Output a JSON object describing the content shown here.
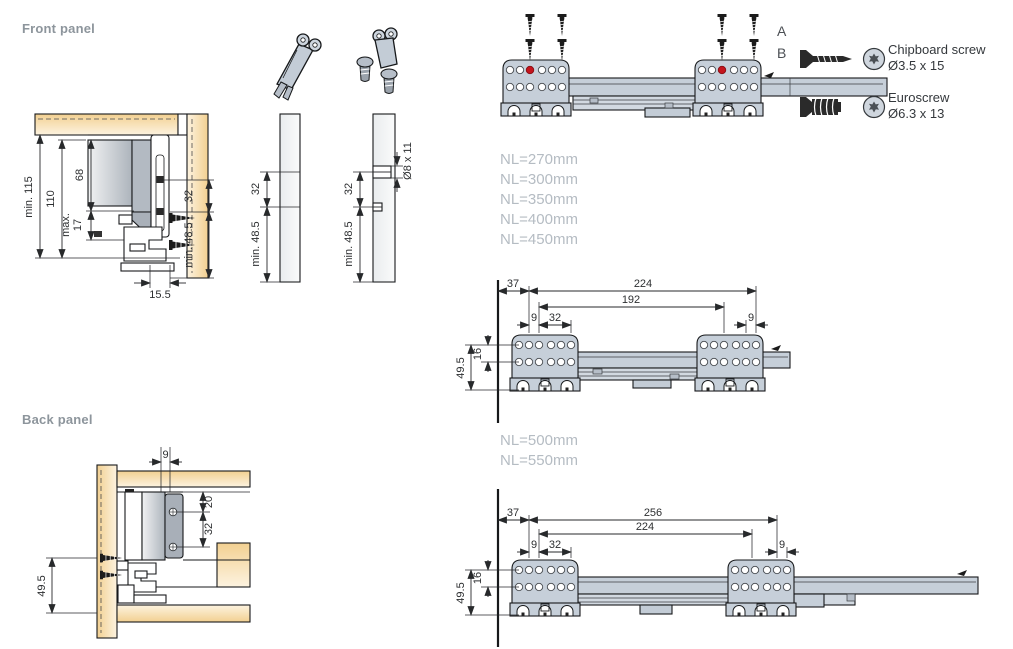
{
  "labels": {
    "front_panel": "Front panel",
    "back_panel": "Back panel",
    "pos_a": "A",
    "pos_b": "B"
  },
  "legend": {
    "chipboard_name": "Chipboard screw",
    "chipboard_size": "Ø3.5 x 15",
    "euroscrew_name": "Euroscrew",
    "euroscrew_size": "Ø6.3 x 13"
  },
  "nominal_lengths_short": [
    "NL=270mm",
    "NL=300mm",
    "NL=350mm",
    "NL=400mm",
    "NL=450mm"
  ],
  "nominal_lengths_long": [
    "NL=500mm",
    "NL=550mm"
  ],
  "front_section": {
    "min_height": "min. 115",
    "height": "110",
    "top": "68",
    "max_label": "max.",
    "overlap": "17",
    "pitch": "32",
    "min_edge": "min. 48.5",
    "inset": "15.5"
  },
  "panel_plain": {
    "pitch": "32",
    "min_edge": "min. 48.5"
  },
  "panel_drilled": {
    "pitch": "32",
    "min_edge": "min. 48.5",
    "drill": "Ø8 x 11"
  },
  "mid_slide": {
    "front_gap": "37",
    "span_outer": "224",
    "span_inner": "192",
    "hole_offset": "9",
    "pitch": "32",
    "rear_offset": "9",
    "row_gap": "16",
    "height": "49.5"
  },
  "bottom_slide": {
    "front_gap": "37",
    "span_outer": "256",
    "span_inner": "224",
    "hole_offset": "9",
    "pitch": "32",
    "rear_offset": "9",
    "row_gap": "16",
    "height": "49.5"
  },
  "back_section": {
    "offset": "9",
    "top_gap": "20",
    "pitch": "32",
    "height": "49.5"
  },
  "colors": {
    "wood": "#f4d598",
    "wood_light": "#fdf3e0",
    "hardware": "#c6cfd9",
    "outline": "#17191b",
    "red_hole": "#c5151d",
    "label_gray": "#8d959c",
    "nl_gray": "#b5bcc3"
  },
  "icons": {
    "front_bracket_hook": "front-bracket-hook-icon",
    "front_bracket_screws": "front-bracket-screws-icon",
    "chipboard_screw": "chipboard-screw-icon",
    "euroscrew": "euroscrew-icon",
    "torx_head": "torx-head-icon",
    "mounting_screw": "screw-icon",
    "rail_arrow": "rail-arrow-icon"
  }
}
